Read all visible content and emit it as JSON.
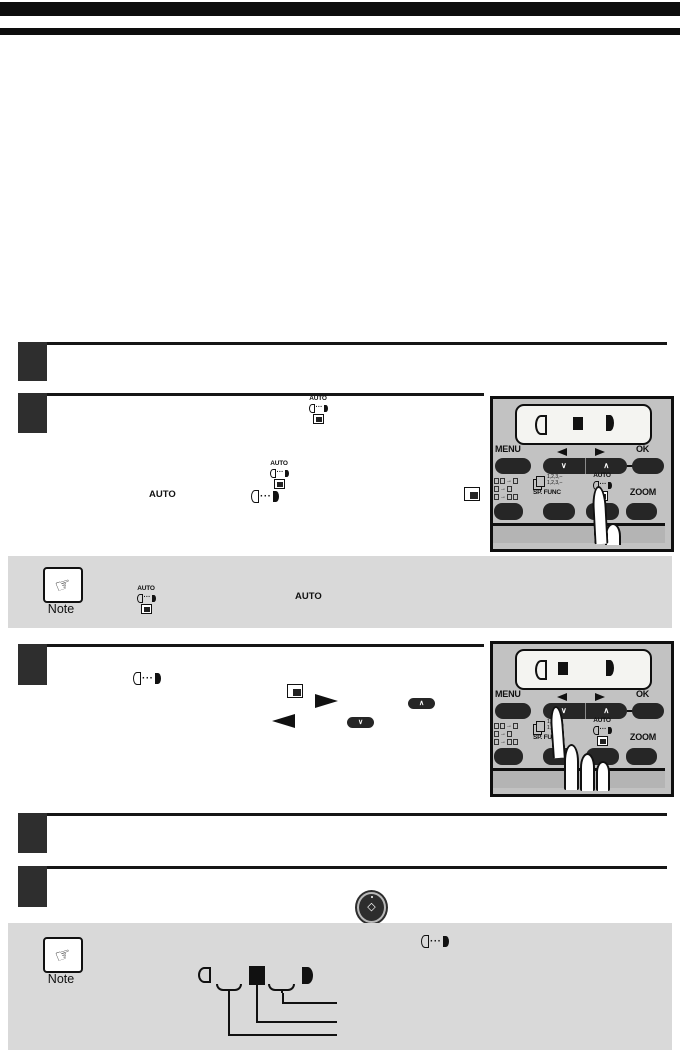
{
  "colors": {
    "page_bg": "#ffffff",
    "header_bar": "#0d0d0d",
    "step_box": "#2e2e2e",
    "note_bg": "#d9d9d9",
    "panel_bg": "#c2c2c2",
    "display_bg": "#f4f4f1",
    "button_dark": "#262626"
  },
  "note": {
    "label": "Note"
  },
  "panel": {
    "menu": "MENU",
    "ok": "OK",
    "sp_func": "SP. FUNC",
    "zoom": "ZOOM",
    "auto": "AUTO",
    "copies_line": "1,2,3,–",
    "chevron_down": "∨",
    "chevron_up": "∧"
  },
  "inline": {
    "auto": "AUTO",
    "dots": "···"
  },
  "icons": {
    "note_hand": "☞",
    "start_diamond": "◇",
    "duplex_arrow": "→"
  }
}
